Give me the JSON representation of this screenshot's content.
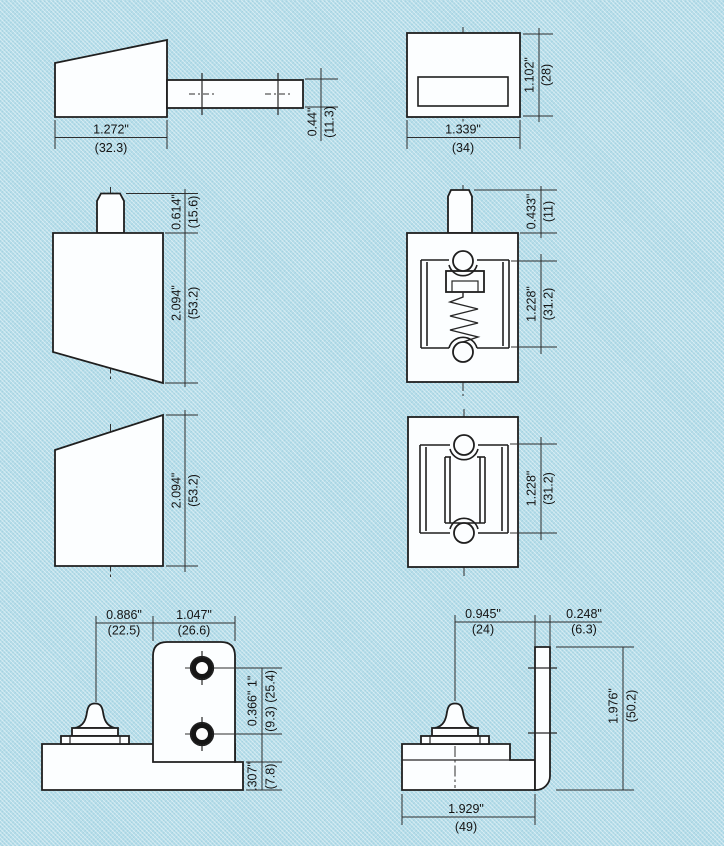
{
  "colors": {
    "background": "#b6dde9",
    "ink": "#1f1f1f",
    "fill": "#fcfeff"
  },
  "views": {
    "bolt_retracted": {
      "width_in": "1.272\"",
      "width_mm": "(32.3)",
      "rod_in": "0.44\"",
      "rod_mm": "(11.3)"
    },
    "housing_face": {
      "width_in": "1.339\"",
      "width_mm": "(34)",
      "height_in": "1.102\"",
      "height_mm": "(28)"
    },
    "bolt_extended": {
      "stem_in": "0.614\"",
      "stem_mm": "(15.6)",
      "body_in": "2.094\"",
      "body_mm": "(53.2)"
    },
    "latch_spring": {
      "stem_in": "0.433\"",
      "stem_mm": "(11)",
      "frame_in": "1.228\"",
      "frame_mm": "(31.2)"
    },
    "bolt_plate": {
      "body_in": "2.094\"",
      "body_mm": "(53.2)"
    },
    "latch_face": {
      "frame_in": "1.228\"",
      "frame_mm": "(31.2)"
    },
    "bracket_a": {
      "offset_in": "0.886\"",
      "offset_mm": "(22.5)",
      "plate_in": "1.047\"",
      "plate_mm": "(26.6)",
      "holes_in": "0.366\"  1\"",
      "holes_mm": "(9.3) (25.4)",
      "base_in": ".307\"",
      "base_mm": "(7.8)"
    },
    "bracket_b": {
      "knob_in": "0.945\"",
      "knob_mm": "(24)",
      "thickness_in": "0.248\"",
      "thickness_mm": "(6.3)",
      "height_in": "1.976\"",
      "height_mm": "(50.2)",
      "length_in": "1.929\"",
      "length_mm": "(49)"
    }
  }
}
